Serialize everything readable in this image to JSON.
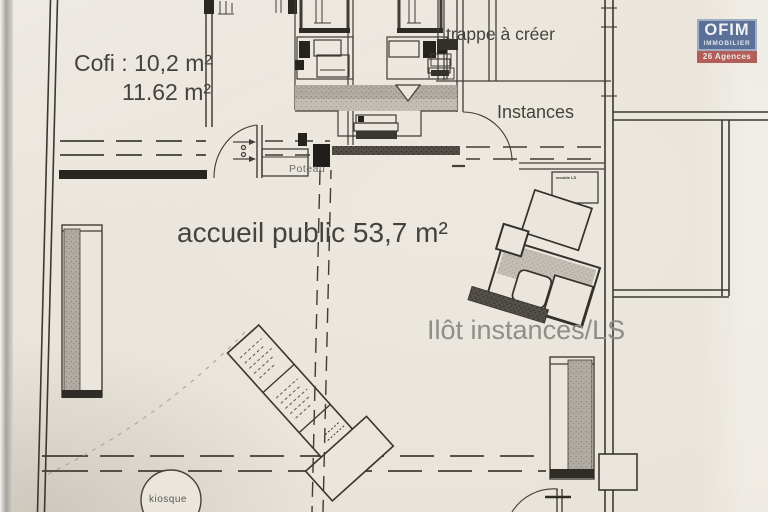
{
  "document": {
    "type": "architectural floor plan photo"
  },
  "labels": {
    "cofi_line1": "Cofi : 10,2 m²",
    "cofi_line2": "11.62 m²",
    "trappe": "trappe à créer",
    "instances": "Instances",
    "poteau": "Poteau",
    "accueil": "accueil public 53,7 m²",
    "ilot_instances": "Ilôt instances/LS",
    "kiosque": "kiosque",
    "meuble_ls": "meuble LS"
  },
  "logo": {
    "name": "OFIM",
    "tagline": "IMMOBILIER",
    "agencies": "26 Agences"
  },
  "colors": {
    "paper": "#eae6dd",
    "ink": "#45423d",
    "wall_dark": "#2e2b27",
    "faded_text": "#8e8d88",
    "logo_blue": "#4b689d",
    "logo_red": "#c04e49"
  }
}
